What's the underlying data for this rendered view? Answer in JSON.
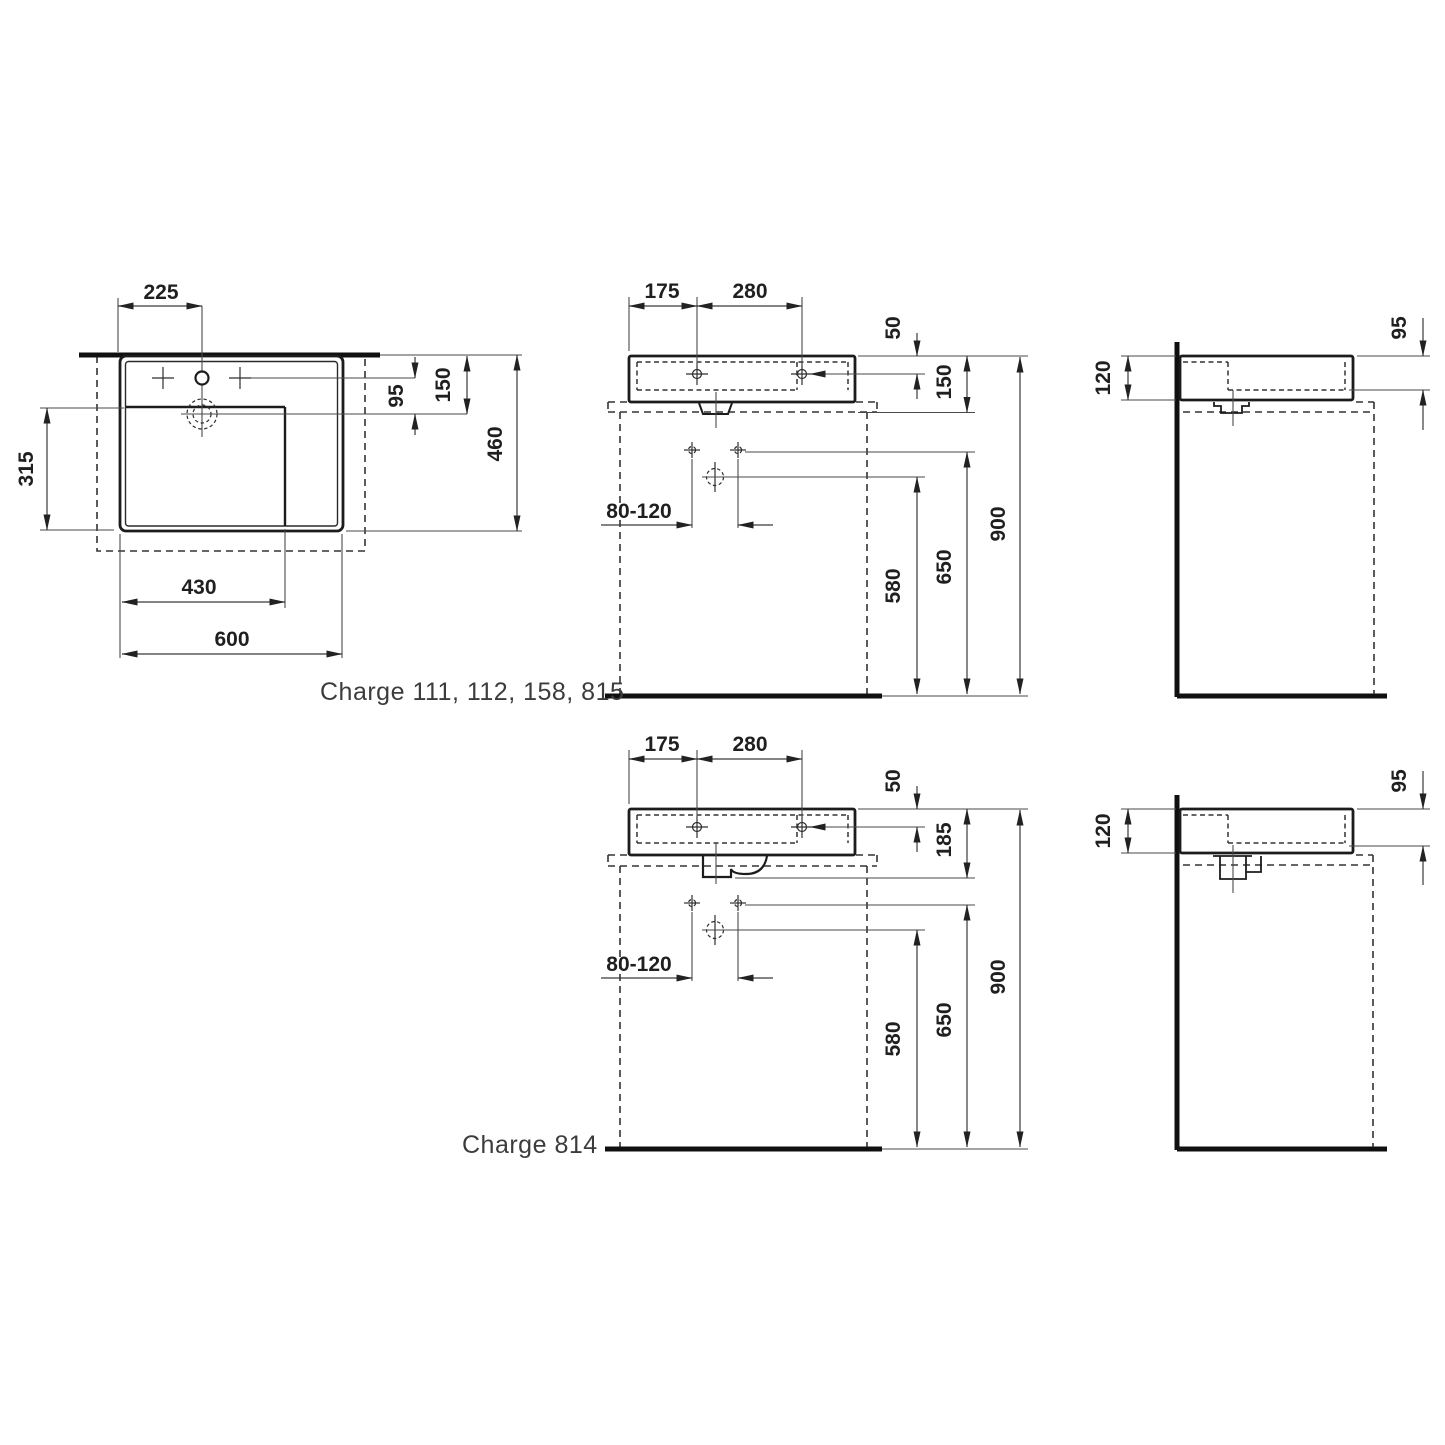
{
  "product": {
    "series_label_top": "Charge 111, 112, 158, 815",
    "series_label_bottom": "Charge 814"
  },
  "views": {
    "plan": {
      "dims": {
        "tap_hole_offset": "225",
        "tap_to_drain": "95",
        "front_to_drain": "150",
        "total_depth": "460",
        "bowl_depth": "315",
        "bowl_width": "430",
        "total_width": "600"
      }
    },
    "front_top": {
      "dims": {
        "edge_to_tap": "175",
        "tap_spacing": "280",
        "rim_to_tap_axis": "50",
        "body_height": "150",
        "waste_range": "80-120",
        "drain_height": "580",
        "fixing_height": "650",
        "rim_height": "900"
      }
    },
    "side_top": {
      "dims": {
        "depth_at_wall": "120",
        "depth_at_front": "95"
      }
    },
    "front_bottom": {
      "dims": {
        "edge_to_tap": "175",
        "tap_spacing": "280",
        "rim_to_tap_axis": "50",
        "body_with_trap_height": "185",
        "waste_range": "80-120",
        "drain_height": "580",
        "fixing_height": "650",
        "rim_height": "900"
      }
    },
    "side_bottom": {
      "dims": {
        "depth_at_wall": "120",
        "depth_at_front": "95"
      }
    }
  }
}
